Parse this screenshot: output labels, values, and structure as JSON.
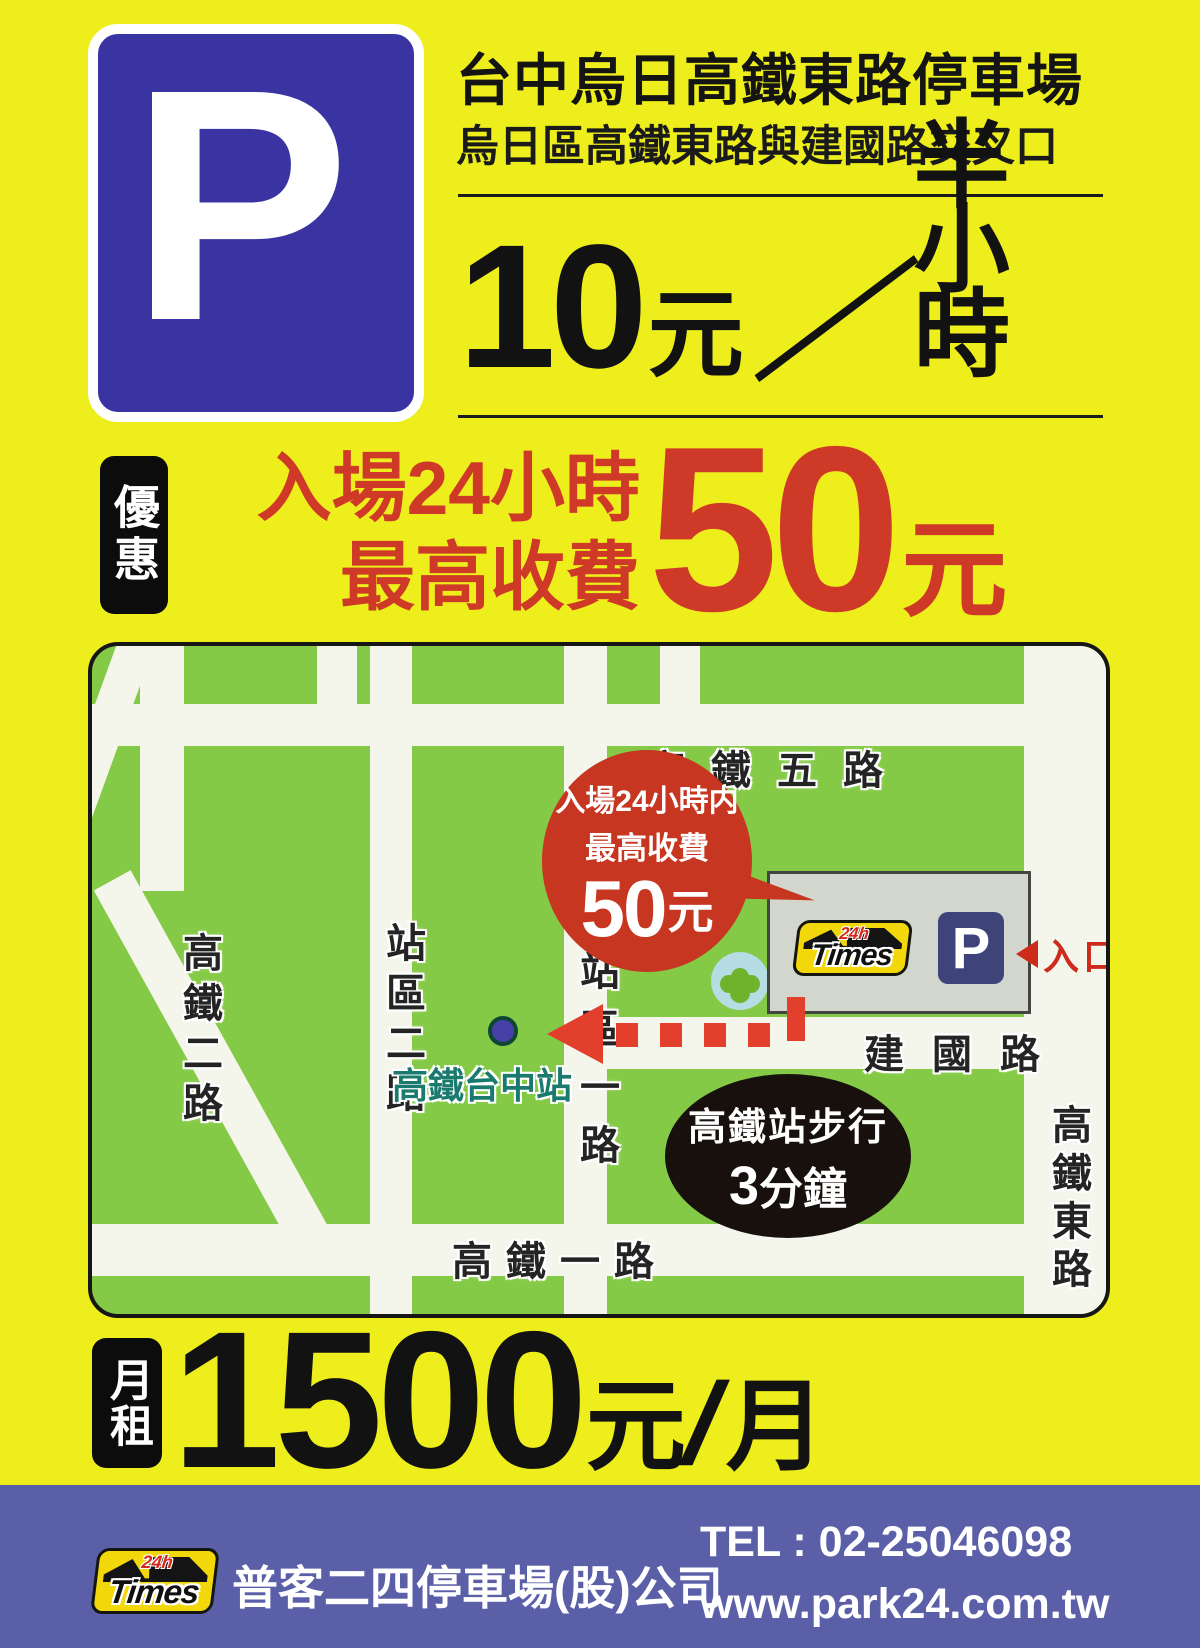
{
  "colors": {
    "background_yellow": "#edee1c",
    "accent_red": "#ce3a27",
    "map_green": "#85ca46",
    "sign_blue": "#3a34a2",
    "map_p_blue": "#3e4379",
    "footer_blue": "#5a5fa8",
    "times_yellow": "#f2d70a",
    "station_teal": "#197a6d"
  },
  "header": {
    "p_logo": "P",
    "title": "台中烏日高鐵東路停車場",
    "subtitle": "烏日區高鐵東路與建國路交叉口",
    "rate": {
      "amount": "10",
      "unit": "元",
      "separator": "／",
      "per": "半小時"
    }
  },
  "promo": {
    "badge": "優惠",
    "line1": "入場24小時",
    "line2": "最高收費",
    "price": {
      "amount": "50",
      "unit": "元"
    }
  },
  "map": {
    "road_labels": {
      "gaotie5": "高鐵五路",
      "gaotie2": "高鐵二路",
      "zhanqu2": "站區二路",
      "zhanqu1": "站區一路",
      "jianguo": "建國路",
      "gaotie1": "高鐵一路",
      "gaotie_east": "高鐵東路"
    },
    "bubble": {
      "line1": "入場24小時内",
      "line2": "最高收費",
      "amount": "50",
      "unit": "元"
    },
    "parking": {
      "times": "Times",
      "hours": "24h",
      "p": "P",
      "entrance": "入口"
    },
    "station": {
      "label": "高鐵台中站"
    },
    "walk": {
      "line1": "高鐵站步行",
      "amount": "3",
      "unit": "分鐘"
    }
  },
  "monthly": {
    "badge": "月租",
    "amount": "1500",
    "unit": "元",
    "separator": "/",
    "per": "月"
  },
  "footer": {
    "logo": {
      "times": "Times",
      "hours": "24h"
    },
    "company": "普客二四停車場(股)公司",
    "tel": "TEL : 02-25046098",
    "website": "www.park24.com.tw"
  }
}
